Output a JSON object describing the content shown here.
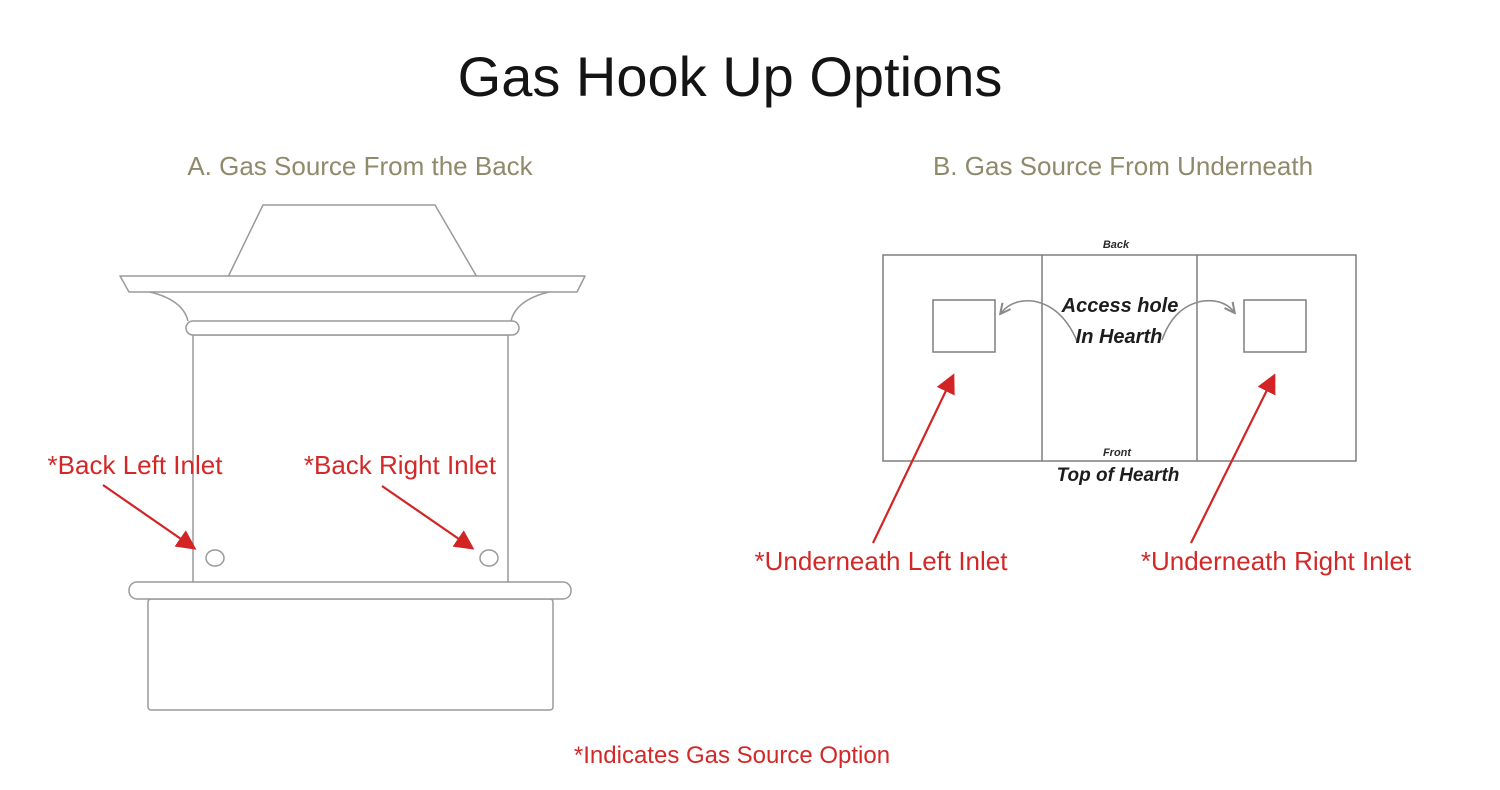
{
  "page": {
    "title": "Gas Hook Up Options",
    "footnote": "*Indicates Gas Source Option"
  },
  "colors": {
    "heading_olive": "#8f8a6b",
    "label_red": "#d32828",
    "arrow_red": "#d22424",
    "drawing_line_gray": "#949494",
    "title_black": "#141414"
  },
  "section_a": {
    "heading": "A. Gas Source From the Back",
    "labels": {
      "back_left_inlet": "*Back Left Inlet",
      "back_right_inlet": "*Back Right Inlet"
    }
  },
  "section_b": {
    "heading": "B. Gas Source From Underneath",
    "diagram_labels": {
      "back": "Back",
      "front": "Front",
      "top_of_hearth": "Top of Hearth",
      "access_hole_line1": "Access hole",
      "access_hole_line2": "In Hearth"
    },
    "labels": {
      "underneath_left_inlet": "*Underneath Left Inlet",
      "underneath_right_inlet": "*Underneath Right Inlet"
    }
  }
}
